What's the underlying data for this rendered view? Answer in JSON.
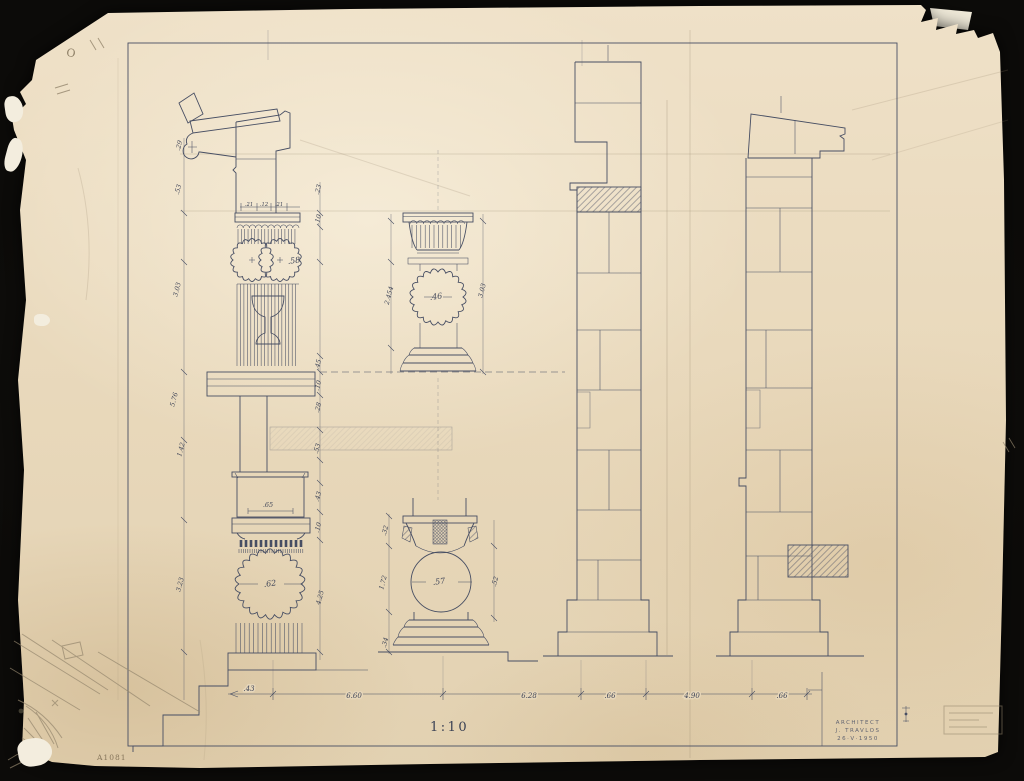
{
  "colors": {
    "ink": "#474e63",
    "pencil": "#94866d",
    "paper": "#e7d7ba",
    "background": "#0f0e0c"
  },
  "scale_label": "1:10",
  "sheet_number": "A1081",
  "title_block": {
    "line1": "ARCHITECT",
    "line2": "J. TRAVLOS",
    "line3": "26·V·1950"
  },
  "corner_note": "O",
  "plan_labels": {
    "left_top": ".58",
    "middle_top": ".46",
    "left_bottom": ".62",
    "middle_bottom": ".57"
  },
  "bottom_dims": [
    ".43",
    "6.60",
    "6.28",
    ".66",
    "4.90",
    ".66"
  ],
  "left_outer_dims": [
    ".29",
    ".53",
    "3.03",
    "5.76",
    "1.42",
    "3.23"
  ],
  "left_inner_dims": [
    ".23",
    ".10",
    ".45",
    ".10",
    ".28",
    ".53",
    ".43",
    ".10",
    "4.25"
  ],
  "abacus_dims": [
    ".21",
    ".12",
    ".21"
  ],
  "block_width_dim": ".65",
  "middle_dims": {
    "left": "2.454",
    "right": "3.03"
  },
  "base_study_dims": {
    "top": ".32",
    "middle": "1.72",
    "bottom": ".34",
    "right": ".52"
  }
}
